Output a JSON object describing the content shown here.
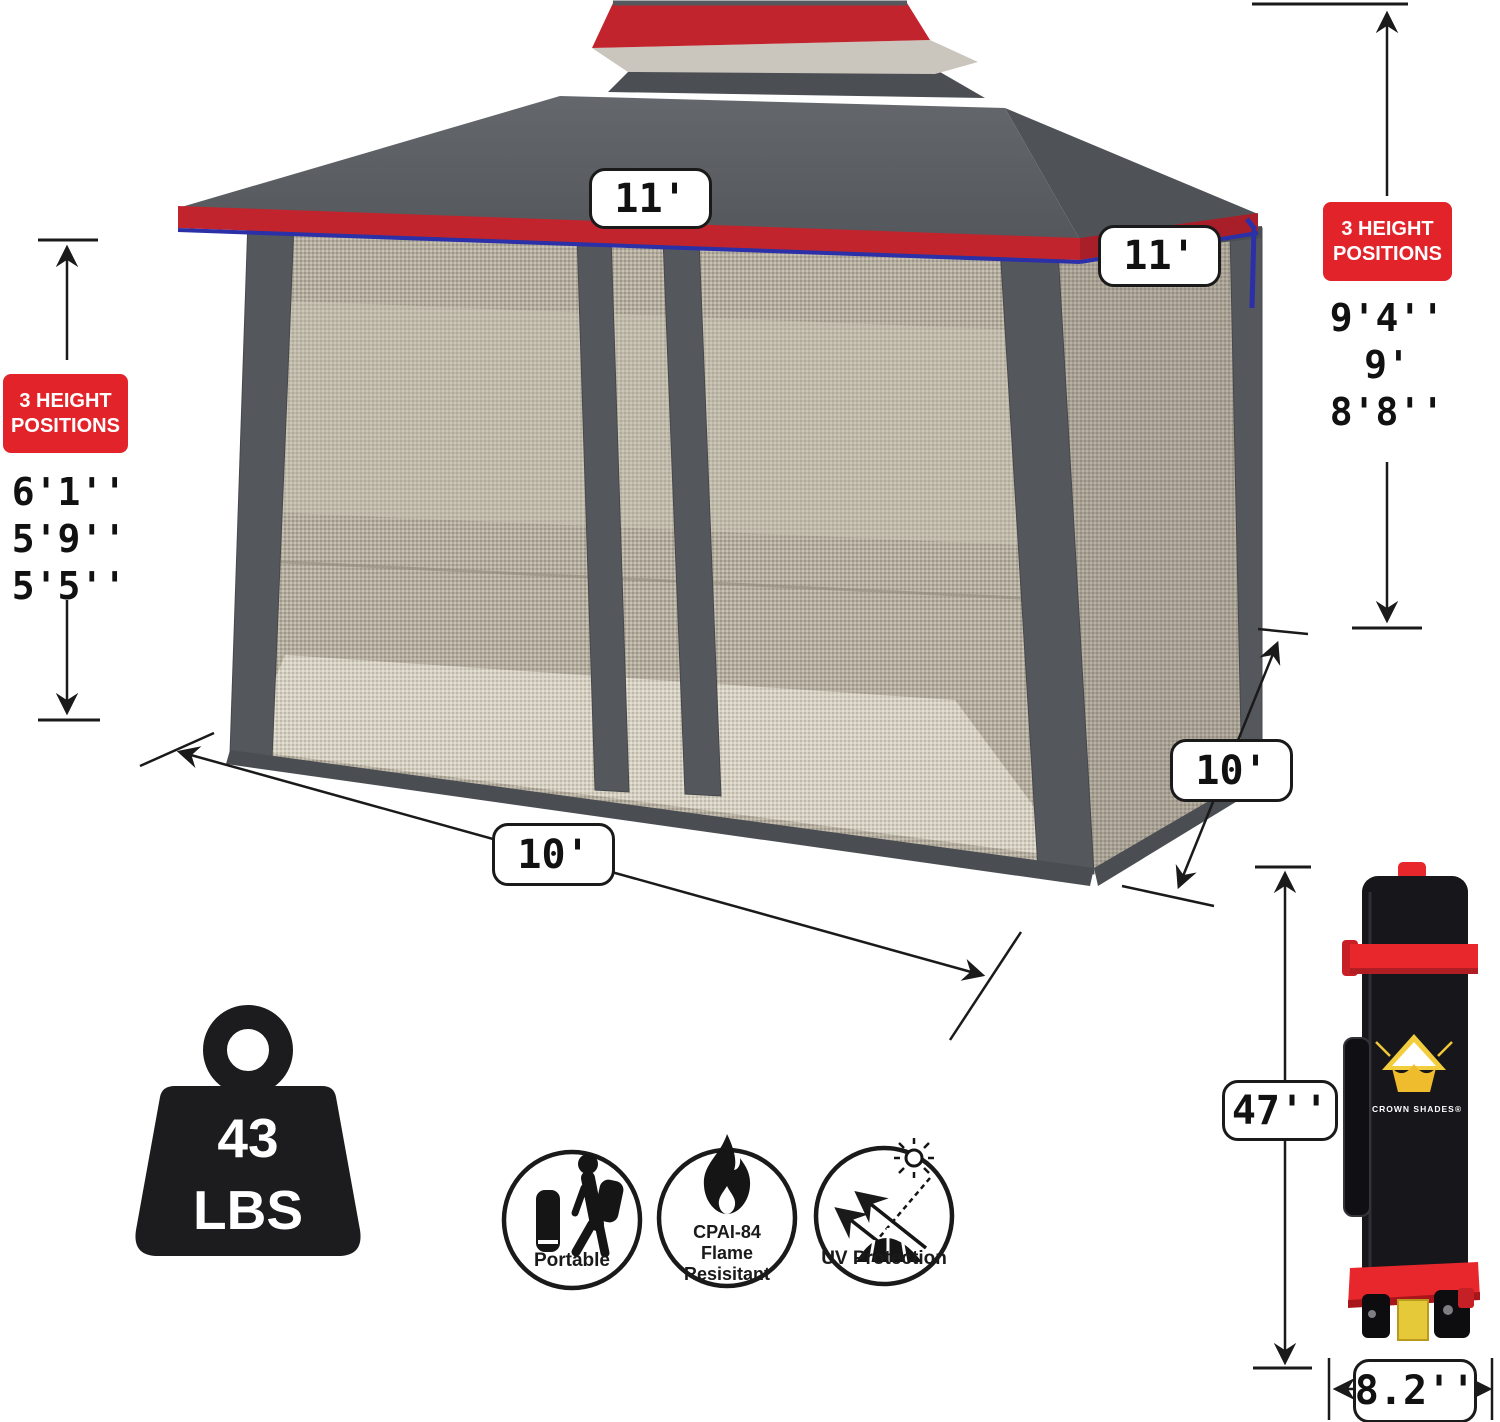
{
  "dimensions": {
    "top_front": "11'",
    "top_side": "11'",
    "bottom_front": "10'",
    "bottom_side": "10'",
    "bag_height": "47''",
    "bag_width": "8.2''"
  },
  "height_left": {
    "badge_line1": "3 HEIGHT",
    "badge_line2": "POSITIONS",
    "values": [
      "6'1''",
      "5'9''",
      "5'5''"
    ]
  },
  "height_right": {
    "badge_line1": "3 HEIGHT",
    "badge_line2": "POSITIONS",
    "values": [
      "9'4''",
      "9'",
      "8'8''"
    ]
  },
  "weight": {
    "value": "43",
    "unit": "LBS"
  },
  "features": {
    "portable": "Portable",
    "flame_line1": "CPAI-84",
    "flame_line2": "Flame",
    "flame_line3": "Resisitant",
    "uv": "UV Protection"
  },
  "bag": {
    "brand": "CROWN SHADES®"
  },
  "colors": {
    "badge_red": "#e2232a",
    "canopy_gray": "#5a5e62",
    "canopy_trim_red": "#c2242e",
    "piping_blue": "#2b2fa8",
    "strap_red": "#e8272d",
    "bag_black": "#17171b"
  }
}
